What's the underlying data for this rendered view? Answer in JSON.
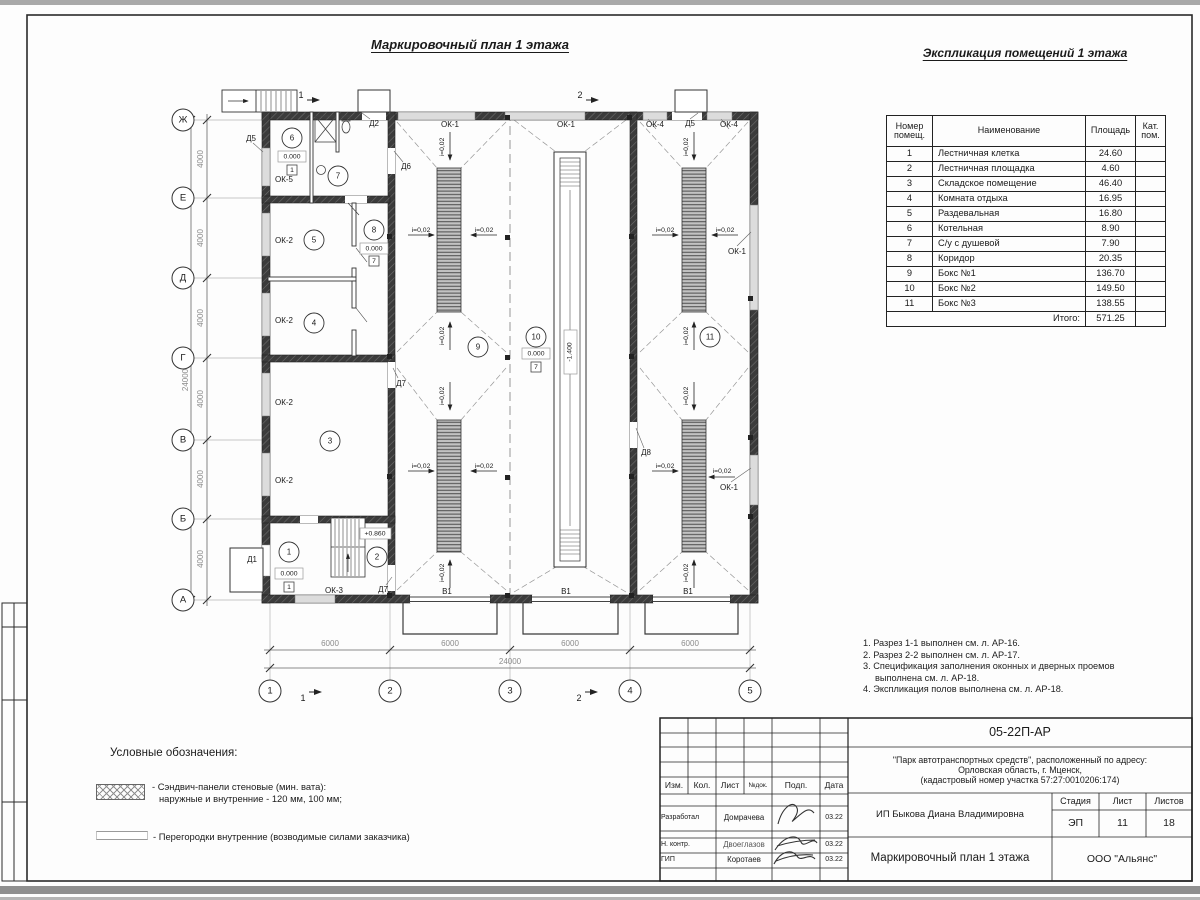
{
  "titles": {
    "plan": "Маркировочный план 1 этажа",
    "table": "Экспликация помещений 1 этажа"
  },
  "axes": {
    "rows": [
      "Ж",
      "Е",
      "Д",
      "Г",
      "В",
      "Б",
      "А"
    ],
    "cols": [
      "1",
      "2",
      "3",
      "4",
      "5"
    ]
  },
  "dims": {
    "d4000": "4000",
    "d6000": "6000",
    "d24000": "24000"
  },
  "marks": {
    "s1": "1",
    "s2": "2"
  },
  "openings": {
    "ok1": "ОК-1",
    "ok2": "ОК-2",
    "ok3": "ОК-3",
    "ok4": "ОК-4",
    "ok5": "ОК-5",
    "d1": "Д1",
    "d2": "Д2",
    "d5": "Д5",
    "d6": "Д6",
    "d7": "Д7",
    "d8": "Д8",
    "v1": "В1"
  },
  "levels": {
    "zero": "0.000",
    "plus": "+0.860",
    "minus": "-1.400"
  },
  "floor": {
    "f1": "1",
    "f7": "7"
  },
  "slope": "i=0,02",
  "rooms": [
    "1",
    "2",
    "3",
    "4",
    "5",
    "6",
    "7",
    "8",
    "9",
    "10",
    "11"
  ],
  "table": {
    "headers": [
      "Номер помещ.",
      "Наименование",
      "Площадь",
      "Кат. пом."
    ],
    "rows": [
      {
        "num": "1",
        "name": "Лестничная клетка",
        "area": "24.60",
        "kat": ""
      },
      {
        "num": "2",
        "name": "Лестничная площадка",
        "area": "4.60",
        "kat": ""
      },
      {
        "num": "3",
        "name": "Складское помещение",
        "area": "46.40",
        "kat": ""
      },
      {
        "num": "4",
        "name": "Комната отдыха",
        "area": "16.95",
        "kat": ""
      },
      {
        "num": "5",
        "name": "Раздевальная",
        "area": "16.80",
        "kat": ""
      },
      {
        "num": "6",
        "name": "Котельная",
        "area": "8.90",
        "kat": ""
      },
      {
        "num": "7",
        "name": "С/у с душевой",
        "area": "7.90",
        "kat": ""
      },
      {
        "num": "8",
        "name": "Коридор",
        "area": "20.35",
        "kat": ""
      },
      {
        "num": "9",
        "name": "Бокс №1",
        "area": "136.70",
        "kat": ""
      },
      {
        "num": "10",
        "name": "Бокс №2",
        "area": "149.50",
        "kat": ""
      },
      {
        "num": "11",
        "name": "Бокс №3",
        "area": "138.55",
        "kat": ""
      }
    ],
    "total_label": "Итого:",
    "total": "571.25"
  },
  "notes": [
    "1. Разрез 1-1 выполнен см. л. АР-16.",
    "2. Разрез 2-2 выполнен см. л. АР-17.",
    "3. Спецификация заполнения оконных и дверных проемов выполнена см. л. АР-18.",
    "4. Экспликация полов выполнена см. л. АР-18."
  ],
  "legend": {
    "title": "Условные обозначения:",
    "item1_line1": "- Сэндвич-панели стеновые (мин. вата):",
    "item1_line2": "наружные и внутренние - 120 мм, 100 мм;",
    "item2": "- Перегородки внутренние (возводимые силами заказчика)"
  },
  "stamp": {
    "doc_number": "05-22П-АР",
    "project_line1": "\"Парк автотранспортных средств\",  расположенный по адресу:",
    "project_line2": "Орловская область, г. Мценск,",
    "project_line3": "(кадастровый номер участка 57:27:0010206:174)",
    "cols": {
      "izm": "Изм.",
      "kol": "Кол.",
      "list": "Лист",
      "ndoc": "№док.",
      "podp": "Подп.",
      "data": "Дата"
    },
    "rows": [
      {
        "role": "Разработал",
        "name": "Домрачева",
        "date": "03.22"
      },
      {
        "role": "Н. контр.",
        "name": "Двоеглазов",
        "date": "03.22"
      },
      {
        "role": "ГИП",
        "name": "Коротаев",
        "date": "03.22"
      }
    ],
    "client": "ИП Быкова Диана Владимировна",
    "stage_label": "Стадия",
    "sheet_label": "Лист",
    "sheets_label": "Листов",
    "stage": "ЭП",
    "sheet": "11",
    "sheets": "18",
    "sheet_title": "Маркировочный план 1 этажа",
    "org": "ООО \"Альянс\""
  }
}
